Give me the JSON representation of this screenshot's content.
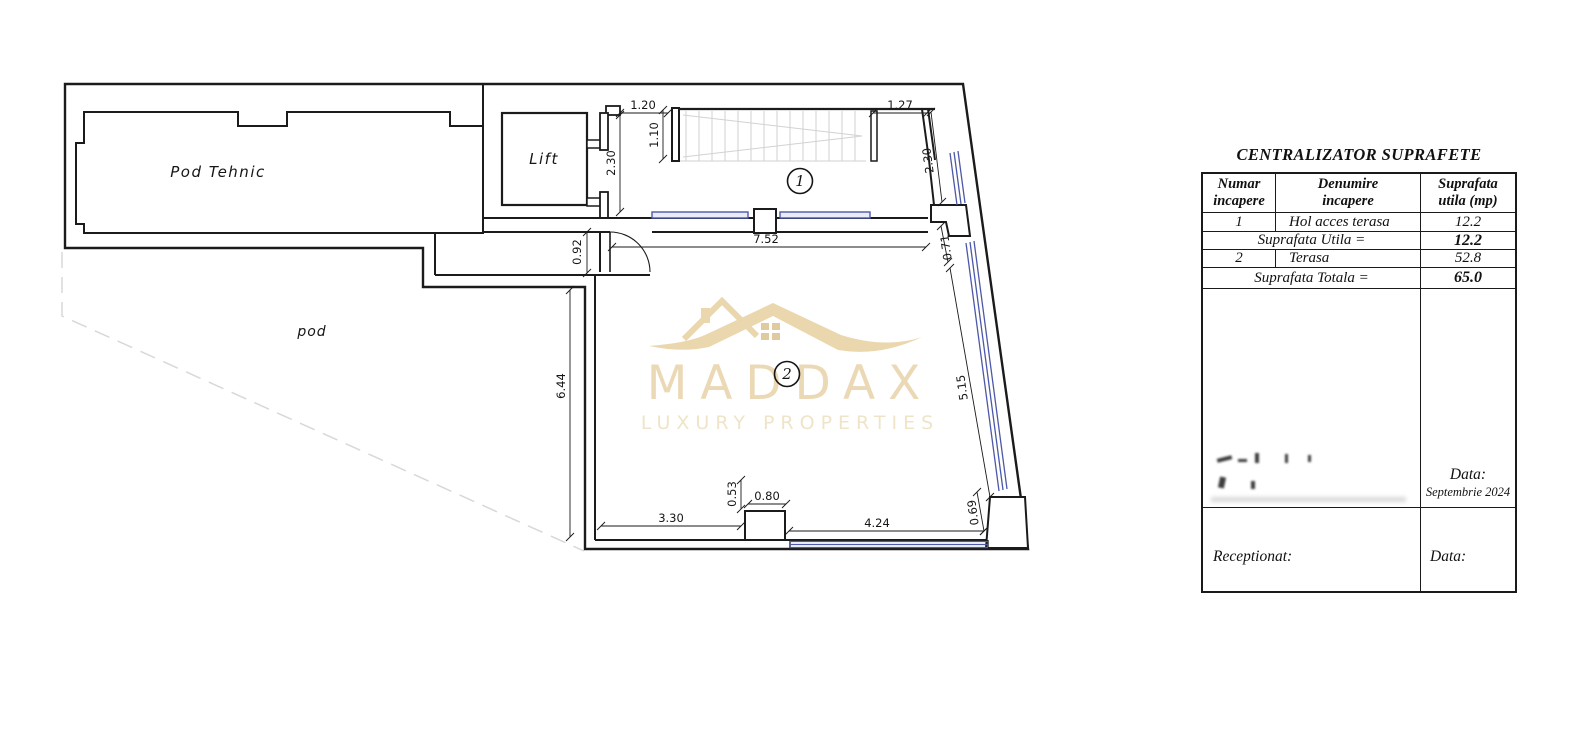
{
  "plan": {
    "labels": {
      "pod_tehnic": "Pod  Tehnic",
      "pod": "pod",
      "lift": "Lift"
    },
    "markers": {
      "room1": "1",
      "room2": "2"
    },
    "dims": {
      "d_120": "1.20",
      "d_110": "1.10",
      "d_230_left": "2.30",
      "d_127": "1.27",
      "d_230_right": "2.30",
      "d_071": "0.71",
      "d_515": "5.15",
      "d_069": "0.69",
      "d_752": "7.52",
      "d_092": "0.92",
      "d_644": "6.44",
      "d_330": "3.30",
      "d_053": "0.53",
      "d_080": "0.80",
      "d_424": "4.24"
    }
  },
  "logo": {
    "brand": "MADDAX",
    "tagline": "LUXURY PROPERTIES",
    "accent_color": "#e7d1a3"
  },
  "table": {
    "title": "CENTRALIZATOR SUPRAFETE",
    "col1_l1": "Numar",
    "col1_l2": "incapere",
    "col2_l1": "Denumire",
    "col2_l2": "incapere",
    "col3_l1": "Suprafata",
    "col3_l2": "utila (mp)",
    "row1_num": "1",
    "row1_name": "Hol acces terasa",
    "row1_area": "12.2",
    "subtotal_label": "Suprafata Utila  =",
    "subtotal_value": "12.2",
    "row2_num": "2",
    "row2_name": "Terasa",
    "row2_area": "52.8",
    "total_label": "Suprafata Totala  =",
    "total_value": "65.0",
    "data_label": "Data:",
    "data_value": "Septembrie 2024",
    "receptionat_label": "Receptionat:",
    "data2_label": "Data:",
    "glazing_color": "#4c58a8"
  }
}
